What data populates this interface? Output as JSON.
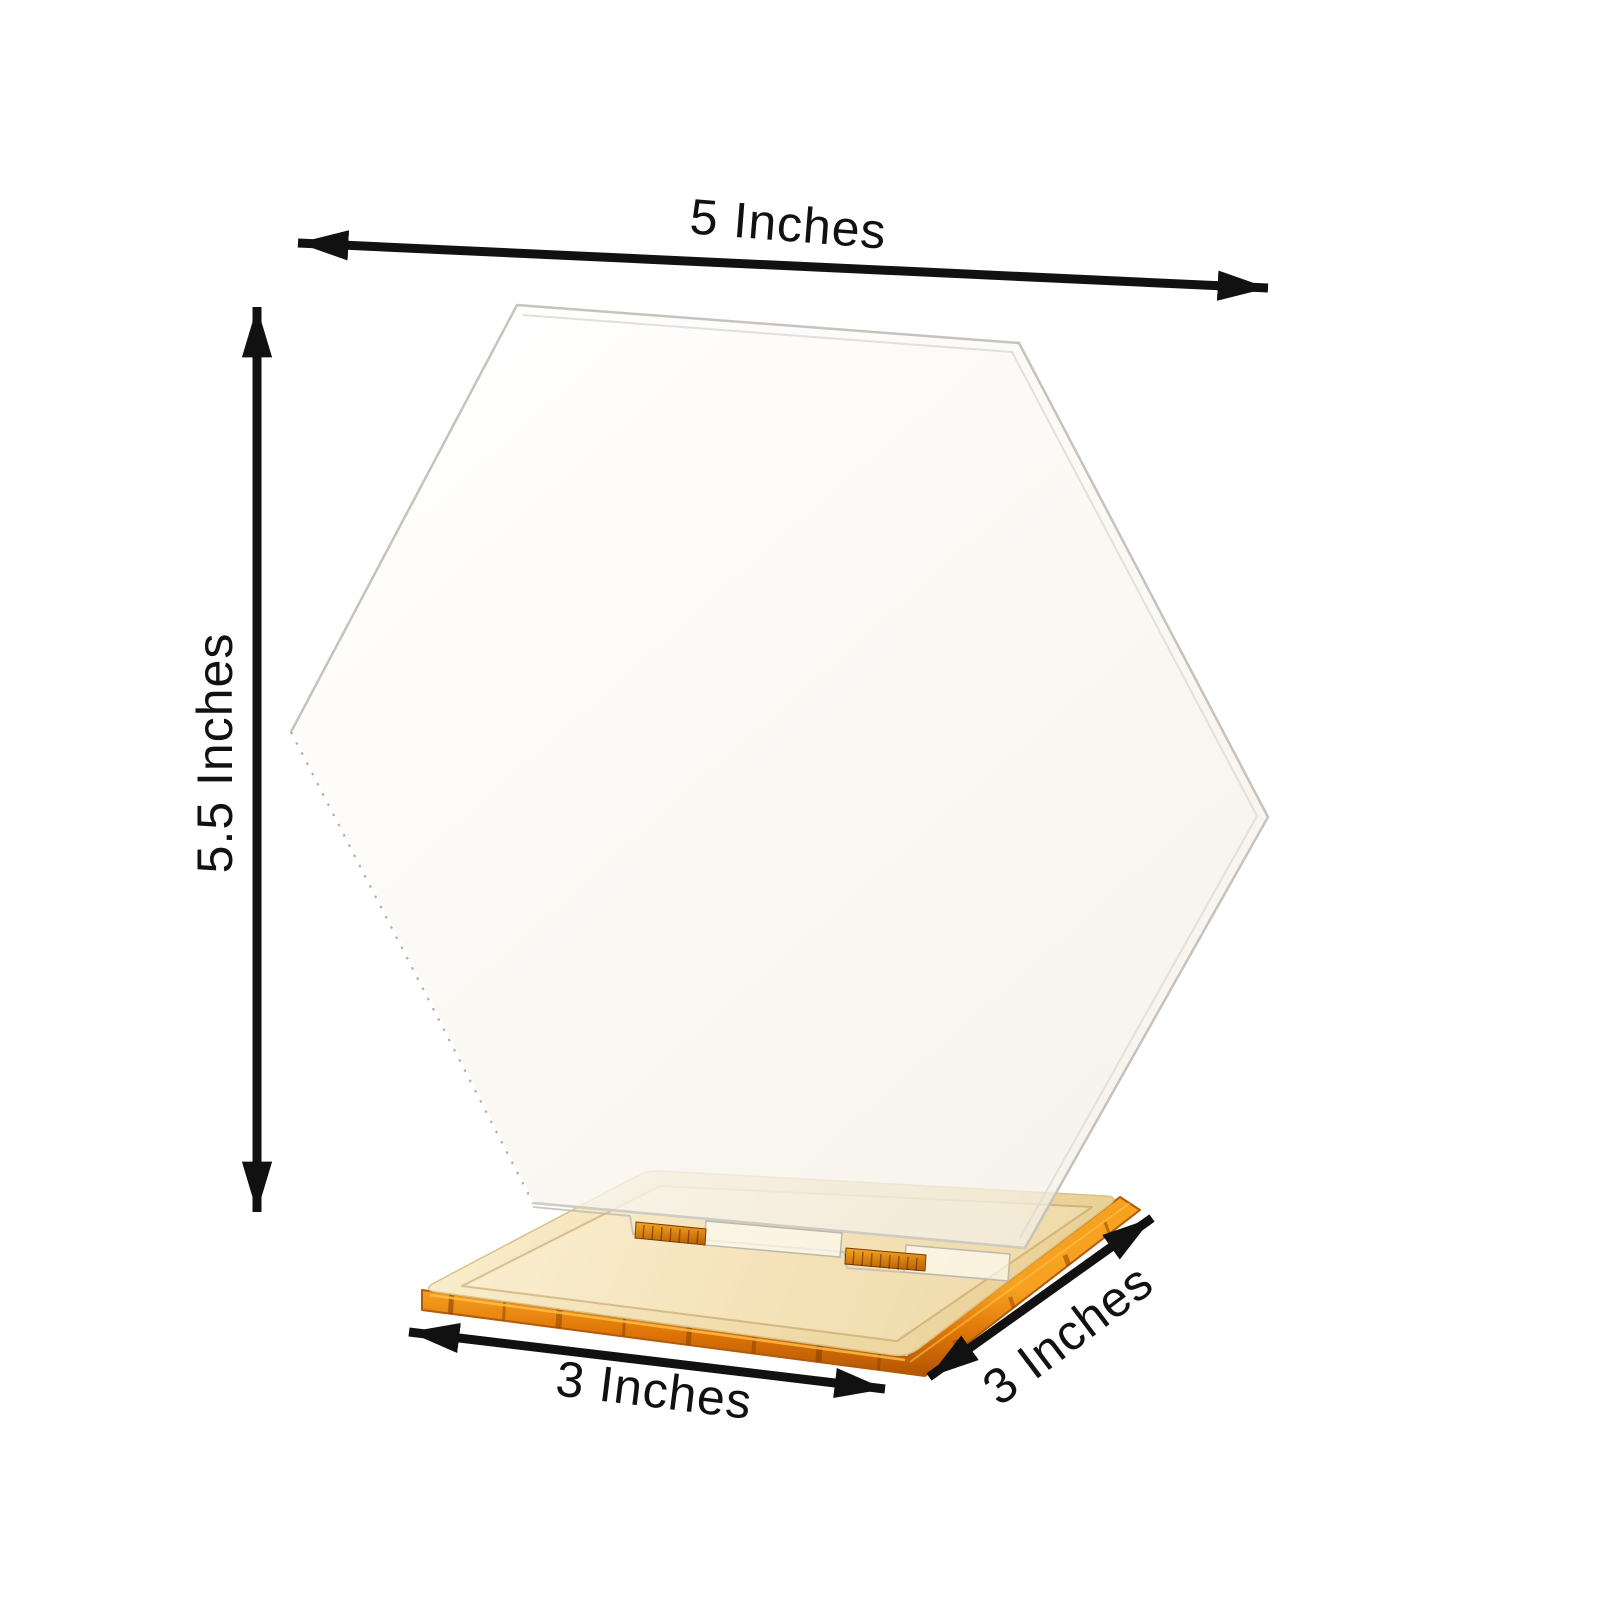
{
  "figure": {
    "type": "product-dimension-diagram",
    "background": "#ffffff"
  },
  "product": {
    "name": "clear acrylic hexagon table sign with gold mirror square base",
    "parts": {
      "sign": "clear acrylic hexagon panel",
      "base": "gold mirror acrylic square base with slot"
    },
    "colors": {
      "base_gold": "#f1dcab",
      "base_gold_light": "#f8ecca",
      "base_gold_deep": "#e9d094",
      "base_edge_orange": "#dd7608",
      "acrylic_edge_gray": "#c6c3bd",
      "annotation_black": "#111111"
    }
  },
  "dimensions": {
    "width": {
      "label": "5 Inches"
    },
    "height": {
      "label": "5.5 Inches"
    },
    "base_width": {
      "label": "3 Inches"
    },
    "base_depth": {
      "label": "3 Inches"
    }
  }
}
